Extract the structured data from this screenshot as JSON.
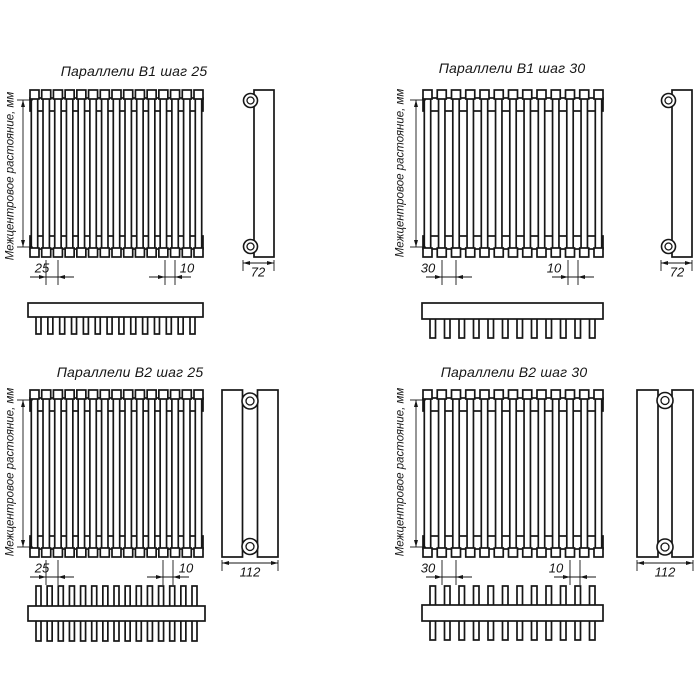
{
  "drawing": {
    "background": "#ffffff",
    "line_color": "#161616",
    "quadrants": [
      {
        "title": "Параллели В1 шаг 25",
        "vertical_label": "Межцентровое растояние, мм",
        "dimensions": {
          "step": "25",
          "tube_width": "10",
          "depth": "72"
        },
        "front_view": {
          "tube_count": 15,
          "rows": 1
        },
        "top_view": {
          "teeth_count": 14,
          "double_sided": false
        },
        "side_view": {
          "columns": 1,
          "connection_count": 2
        }
      },
      {
        "title": "Параллели В1 шаг 30",
        "vertical_label": "Межцентровое растояние, мм",
        "dimensions": {
          "step": "30",
          "tube_width": "10",
          "depth": "72"
        },
        "front_view": {
          "tube_count": 13,
          "rows": 1
        },
        "top_view": {
          "teeth_count": 12,
          "double_sided": false
        },
        "side_view": {
          "columns": 1,
          "connection_count": 2
        }
      },
      {
        "title": "Параллели В2 шаг 25",
        "vertical_label": "Межцентровое растояние, мм",
        "dimensions": {
          "step": "25",
          "tube_width": "10",
          "depth": "112"
        },
        "front_view": {
          "tube_count": 15,
          "rows": 2
        },
        "top_view": {
          "teeth_count": 15,
          "double_sided": true
        },
        "side_view": {
          "columns": 2,
          "connection_count": 2
        }
      },
      {
        "title": "Параллели В2 шаг 30",
        "vertical_label": "Межцентровое растояние, мм",
        "dimensions": {
          "step": "30",
          "tube_width": "10",
          "depth": "112"
        },
        "front_view": {
          "tube_count": 13,
          "rows": 2
        },
        "top_view": {
          "teeth_count": 12,
          "double_sided": true
        },
        "side_view": {
          "columns": 2,
          "connection_count": 2
        }
      }
    ]
  }
}
